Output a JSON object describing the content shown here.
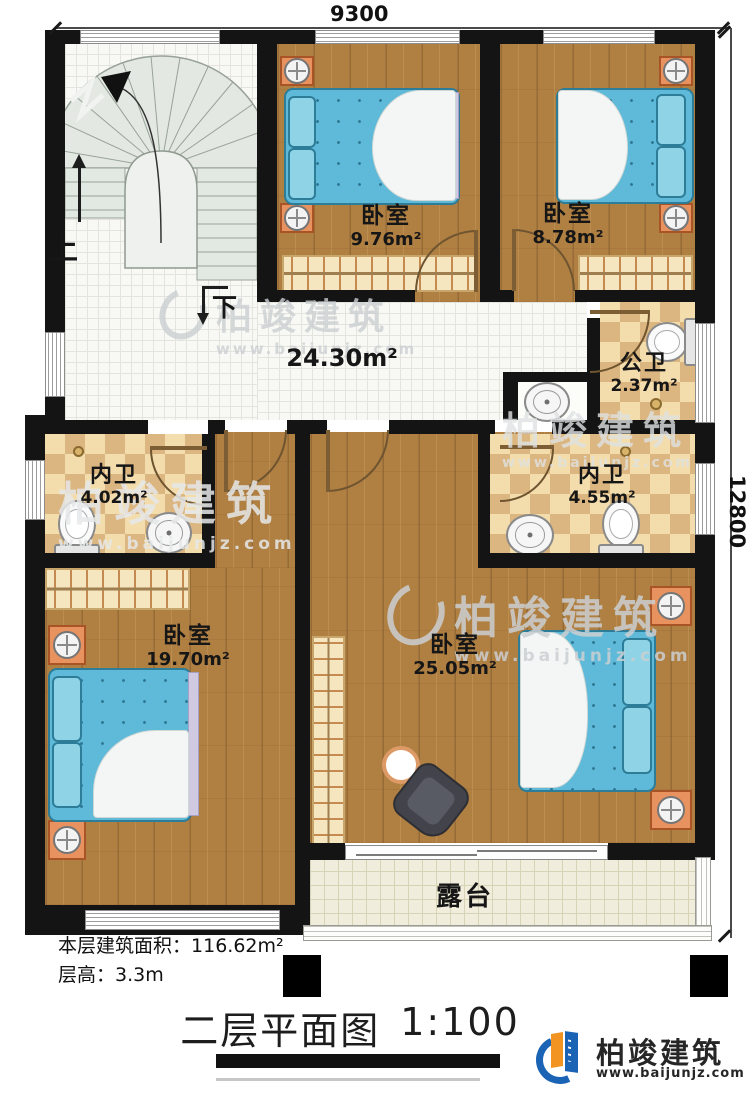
{
  "plan": {
    "dimensions": {
      "width_label": "9300",
      "height_label": "12800"
    },
    "stairs": {
      "up_label": "上",
      "down_label": "下"
    },
    "rooms": {
      "bedroom_top_left": {
        "name": "卧室",
        "area": "9.76m²"
      },
      "bedroom_top_right": {
        "name": "卧室",
        "area": "8.78m²"
      },
      "public_bath": {
        "name": "公卫",
        "area": "2.37m²"
      },
      "ensuite_left": {
        "name": "内卫",
        "area": "4.02m²"
      },
      "ensuite_right": {
        "name": "内卫",
        "area": "4.55m²"
      },
      "bedroom_bottom_left": {
        "name": "卧室",
        "area": "19.70m²"
      },
      "bedroom_bottom_right": {
        "name": "卧室",
        "area": "25.05m²"
      },
      "hallway": {
        "area": "24.30m²"
      },
      "terrace": {
        "name": "露台"
      }
    }
  },
  "footer": {
    "floor_area_label": "本层建筑面积：",
    "floor_area_value": "116.62m²",
    "floor_height_label": "层高：",
    "floor_height_value": "3.3m",
    "title": "二层平面图",
    "scale": "1:100"
  },
  "branding": {
    "logo_text": "柏竣建筑",
    "logo_url": "www.baijunjz.com",
    "watermark_text": "柏竣建筑",
    "watermark_url": "www.baijunjz.com"
  },
  "colors": {
    "wall": "#141414",
    "wood_floor": "#b07f42",
    "tile_floor": "#f8f8f5",
    "checker_light": "#f3ddad",
    "checker_dark": "#dcb680",
    "terrace_floor": "#f0eddc",
    "bed_blue": "#5fb9d8",
    "nightstand_orange": "#e8935f",
    "logo_blue": "#1b63b5",
    "logo_orange": "#f29422"
  }
}
